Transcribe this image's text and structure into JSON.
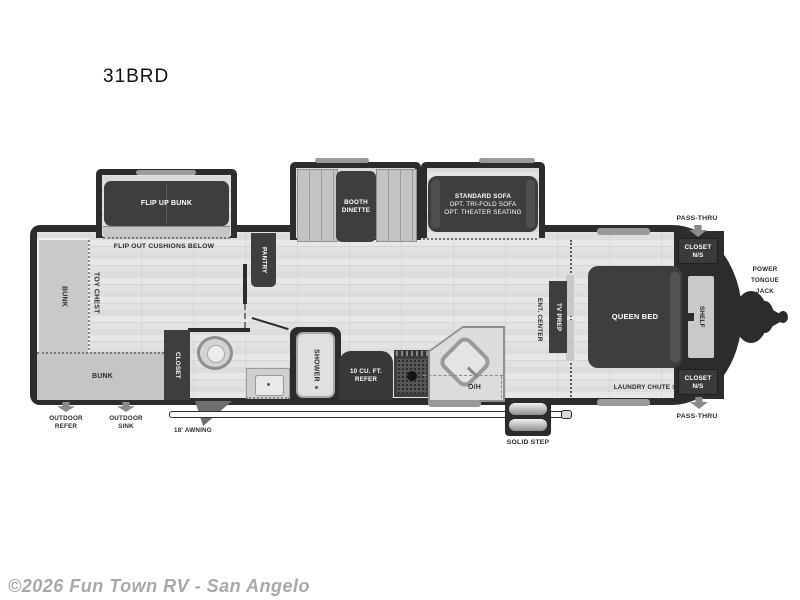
{
  "title": "31BRD",
  "watermark": "©2026 Fun Town RV - San Angelo",
  "colors": {
    "wall": "#2c2c2c",
    "furniture_dark": "#3e3e3e",
    "furniture_light": "#c9c9c9",
    "floor": "#e2e2e2",
    "label_dark": "#2b2b2b",
    "label_light": "#ffffff",
    "watermark": "#a8a8a8"
  },
  "slideouts": {
    "flip_up_bunk": "FLIP UP BUNK",
    "booth_dinette_line1": "BOOTH",
    "booth_dinette_line2": "DINETTE",
    "sofa_line1": "STANDARD SOFA",
    "sofa_line2": "OPT. TRI-FOLD SOFA",
    "sofa_line3": "OPT. THEATER SEATING"
  },
  "interior": {
    "flip_out_cushions": "FLIP OUT CUSHIONS BELOW",
    "bunk_side": "BUNK",
    "toy_chest": "TOY CHEST",
    "bunk_rear": "BUNK",
    "pantry": "PANTRY",
    "closet": "CLOSET",
    "shower": "SHOWER",
    "refer_line1": "10 CU. FT.",
    "refer_line2": "REFER",
    "overhead": "O/H",
    "ent_center": "ENT. CENTER",
    "tv_prep": "TV PREP",
    "queen_bed": "QUEEN BED",
    "shelf": "SHELF",
    "closet_ns_line1": "CLOSET",
    "closet_ns_line2": "N/S",
    "laundry_chute": "LAUNDRY CHUTE >"
  },
  "exterior": {
    "pass_thru": "PASS-THRU",
    "power_tongue_jack_line1": "POWER",
    "power_tongue_jack_line2": "TONGUE",
    "power_tongue_jack_line3": "JACK",
    "outdoor_refer_line1": "OUTDOOR",
    "outdoor_refer_line2": "REFER",
    "outdoor_sink_line1": "OUTDOOR",
    "outdoor_sink_line2": "SINK",
    "awning": "18' AWNING",
    "solid_step": "SOLID STEP"
  }
}
